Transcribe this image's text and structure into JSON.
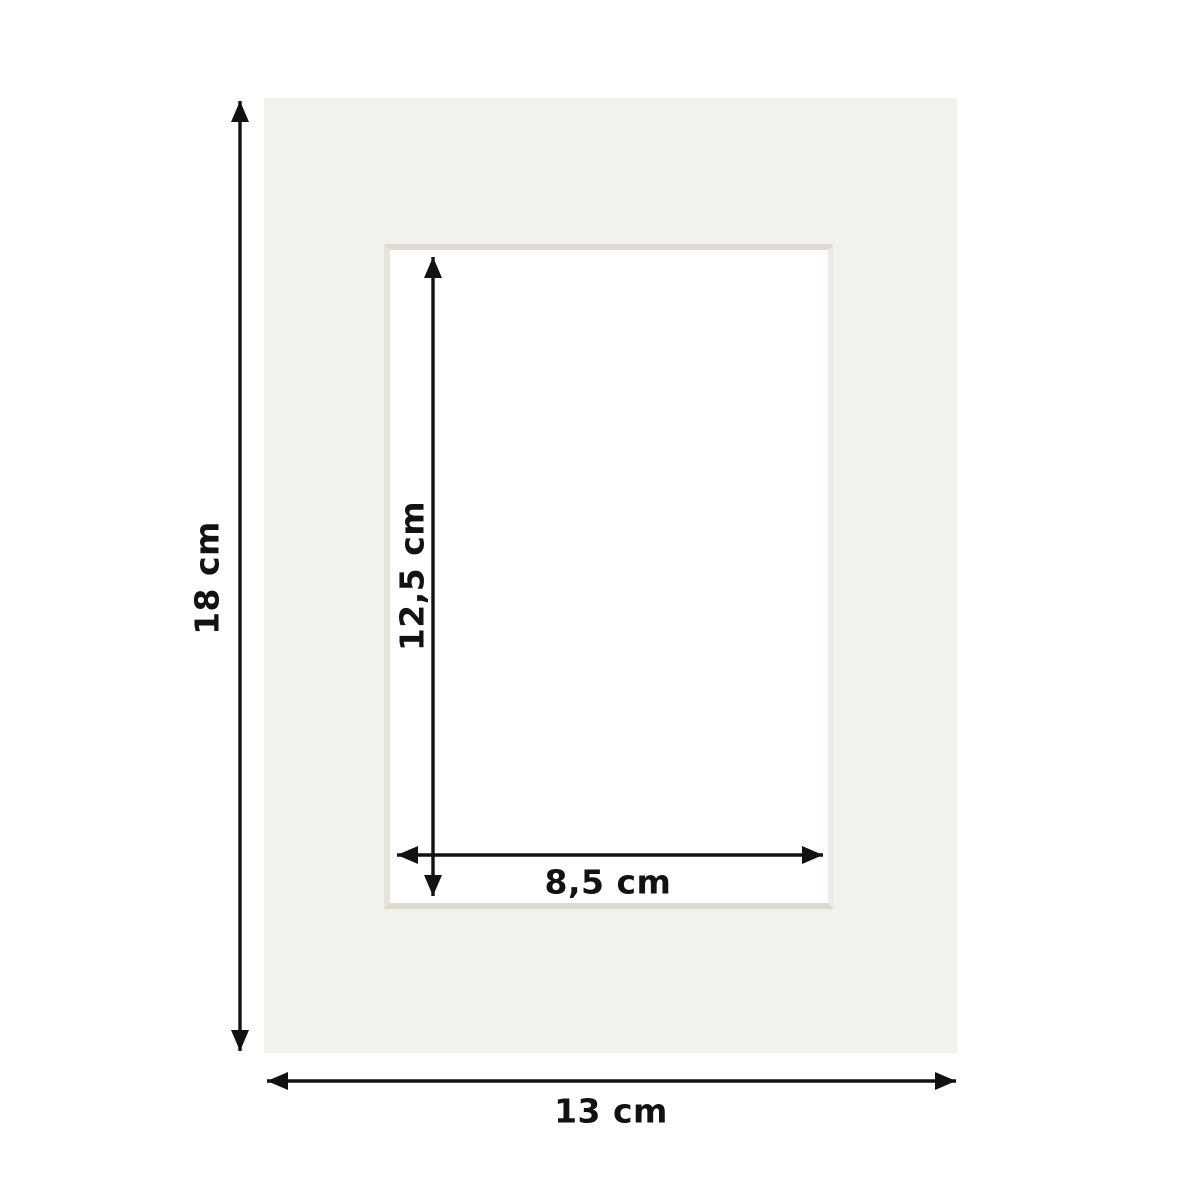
{
  "diagram": {
    "title": "passepartout-mat-dimension-diagram",
    "mat_color": "#f2f1ec",
    "opening_color": "#ffffff",
    "arrow_color": "#121212",
    "dimensions": {
      "outer_height": {
        "label": "18 cm"
      },
      "outer_width": {
        "label": "13 cm"
      },
      "inner_height": {
        "label": "12,5 cm"
      },
      "inner_width": {
        "label": "8,5 cm"
      }
    }
  }
}
